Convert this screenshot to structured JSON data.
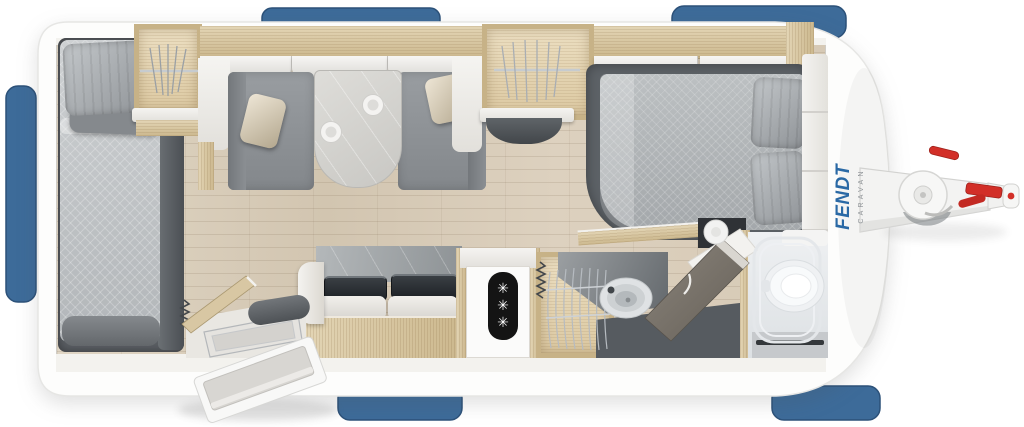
{
  "branding": {
    "brand": "FENDT",
    "sub_brand": "CARAVAN"
  },
  "fridge": {
    "snowflakes": [
      "✳",
      "✳",
      "✳"
    ]
  },
  "icons": {
    "snowflake": "✳"
  },
  "colors": {
    "window_blue": "#3d6b99",
    "window_blue_border": "#2c5179",
    "logo_blue": "#2a69a5",
    "logo_gray": "#8d9296",
    "hitch_red": "#d22f28",
    "body_white": "#fdfdfc",
    "cabinet_wood": "#d9c9a6",
    "floor_wood": "#dbcfbd",
    "upholstery_gray": "#8e9295",
    "frame_dark_gray": "#5c6166"
  }
}
